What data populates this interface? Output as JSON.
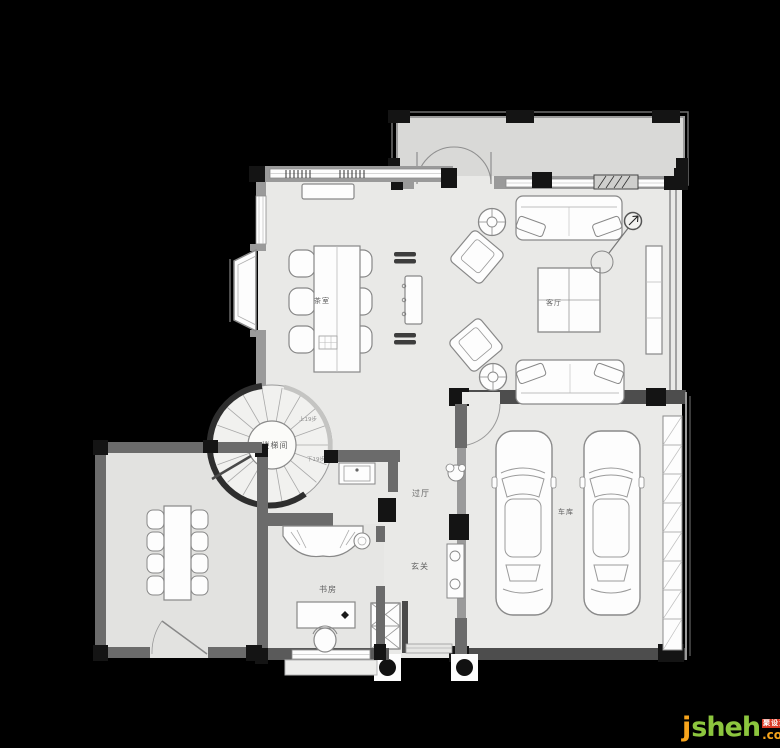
{
  "rooms": {
    "tea_room": "茶室",
    "living_room": "客厅",
    "stairwell": "楼梯间",
    "hallway": "过厅",
    "foyer": "玄关",
    "study": "书房",
    "garage": "车库"
  },
  "annotations": {
    "stairs_up": "上19步",
    "stairs_down": "下19步"
  },
  "watermark": {
    "j": "j",
    "sheh": "sheh",
    "dotcom": ".com",
    "cn": "聚设汇"
  },
  "colors": {
    "watermark_orange": "#f7a41c",
    "watermark_green": "#8cc63e",
    "watermark_red": "#d93a26",
    "floor": "#e9e9e7",
    "terrace_floor": "#d9d9d7",
    "wall": "#6b6b6b"
  }
}
